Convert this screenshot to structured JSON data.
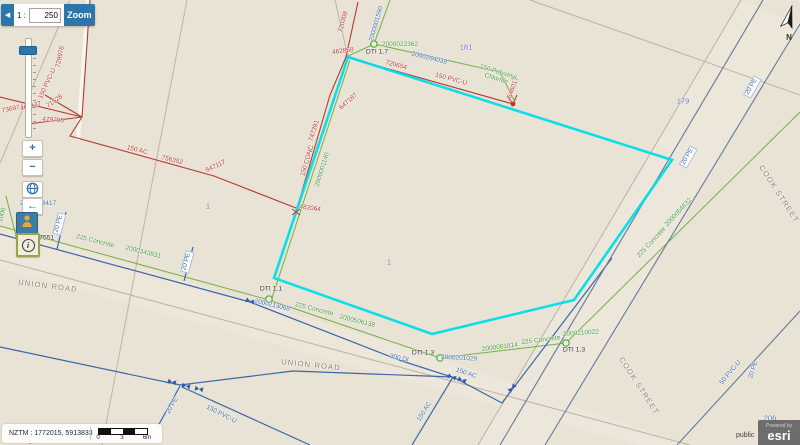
{
  "scale_widget": {
    "collapse_icon": "◀",
    "ratio_prefix": "1 :",
    "ratio_value": "250",
    "zoom_button": "Zoom",
    "zoom_in": "+",
    "zoom_out": "−",
    "back_icon": "←"
  },
  "north_label": "N",
  "map": {
    "red": [
      "729978",
      "150 PVC-U",
      "( 73697 )",
      "467137",
      "71528",
      "479706",
      "150 AC",
      "756352",
      "647117",
      "720308",
      "462858",
      "720654",
      "150 PVC-U",
      "646017",
      "647187",
      "747391",
      "150 CONC",
      "482064"
    ],
    "blue": [
      "2000001590",
      "2000264039",
      "2000263417",
      "20 PE",
      "20 PE",
      "2000213068",
      "300 DI",
      "2000201029",
      "150 AC",
      "150 AC",
      "20 PE",
      "150 PVC-U",
      "20 PE",
      "20 PE",
      "50 PVC-U",
      "20 PE"
    ],
    "green": [
      "2000022362",
      "150 Polyvinyl Chloride",
      "2000001140",
      "225 Concrete",
      "2000343831",
      "225 Concrete",
      "2000506138",
      "2000081814",
      "225 Concrete",
      "2000210022",
      "2000054632",
      "225 Concrete",
      "2000"
    ],
    "dark": [
      "DTI 1.7",
      "DTI 1.1",
      "DTI 1.3",
      "DTI 1.3",
      "217551"
    ],
    "parcels": [
      "181",
      "179",
      "1",
      "1",
      "206"
    ],
    "roads": [
      "UNION ROAD",
      "UNION ROAD",
      "COOK STREET",
      "COOK STREET"
    ],
    "colors": {
      "selected_parcel": "#00dde8",
      "water_main_red": "#b5392f",
      "water_main_blue": "#3a67a8",
      "wastewater_green": "#76b043"
    }
  },
  "statusbar": {
    "coords": "NZTM : 1772015, 5913833",
    "ticks": [
      "0",
      "3",
      "6m"
    ]
  },
  "attribution": {
    "access": "public",
    "powered": "Powered by",
    "brand": "esri"
  }
}
